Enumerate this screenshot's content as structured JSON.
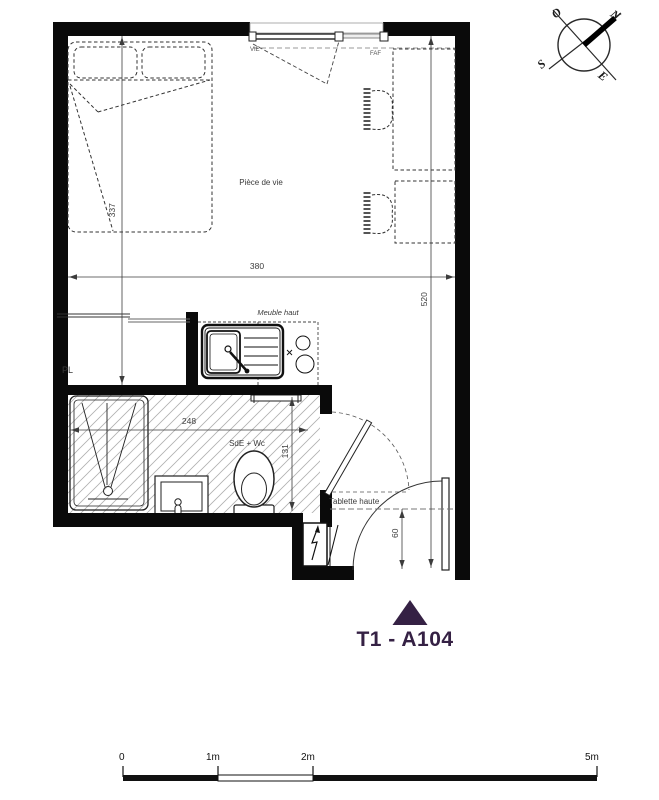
{
  "plan": {
    "living_room_label": "Pièce de vie",
    "bathroom_label": "SdE + Wc",
    "closet_label": "PL",
    "upper_cabinet_label": "Meuble haut",
    "high_shelf_label": "Tablette haute",
    "window_labels": {
      "left": "VIE",
      "right": "FAF"
    },
    "dimensions": {
      "living_width": "380",
      "overall_depth": "520",
      "bed_wall": "337",
      "bathroom_width": "248",
      "bathroom_depth": "131",
      "entry_clearance": "60"
    }
  },
  "compass": {
    "north": "N",
    "south": "S",
    "east": "E",
    "west": "O"
  },
  "title": {
    "unit": "T1 - A104",
    "color": "#352144"
  },
  "scalebar": {
    "labels": [
      "0",
      "1m",
      "2m",
      "5m"
    ]
  }
}
